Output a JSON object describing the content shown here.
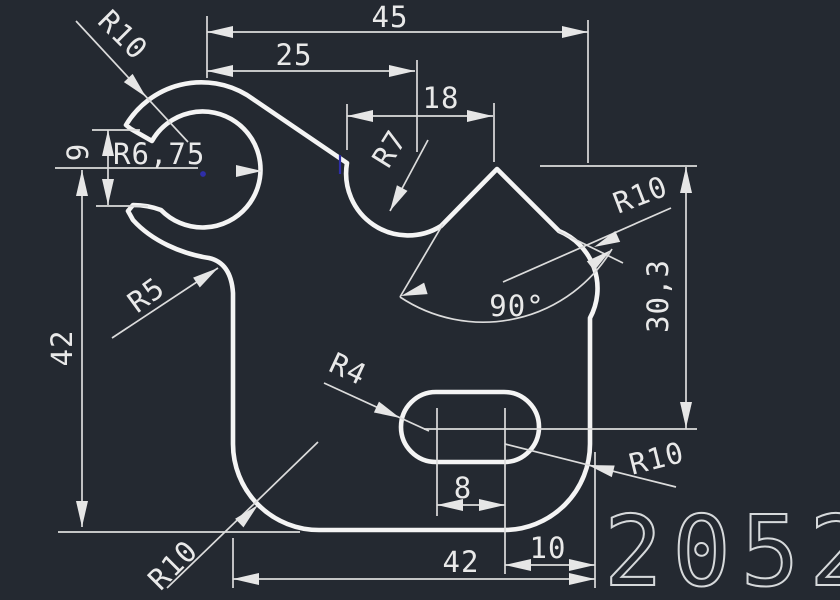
{
  "drawing": {
    "background_color": "#242931",
    "outline_color": "#f4f4f4",
    "dimension_color": "#dcdcdc",
    "grip_color": "#2e2ea8",
    "part_number": "2052",
    "dimensions": {
      "width_total": "45",
      "width_upper": "25",
      "width_notch": "18",
      "mouth_gap": "9",
      "height_left": "42",
      "height_right": "30,3",
      "angle_v": "90°",
      "slot_center_spacing": "8",
      "width_bottom": "42",
      "offset_right": "10"
    },
    "radii": {
      "hook_outer": "R10",
      "hook_inner": "R6,75",
      "notch_left": "R5",
      "valley": "R7",
      "shoulder_right": "R10",
      "slot": "R4",
      "corner_bottom_right": "R10",
      "corner_bottom_left": "R10"
    }
  }
}
